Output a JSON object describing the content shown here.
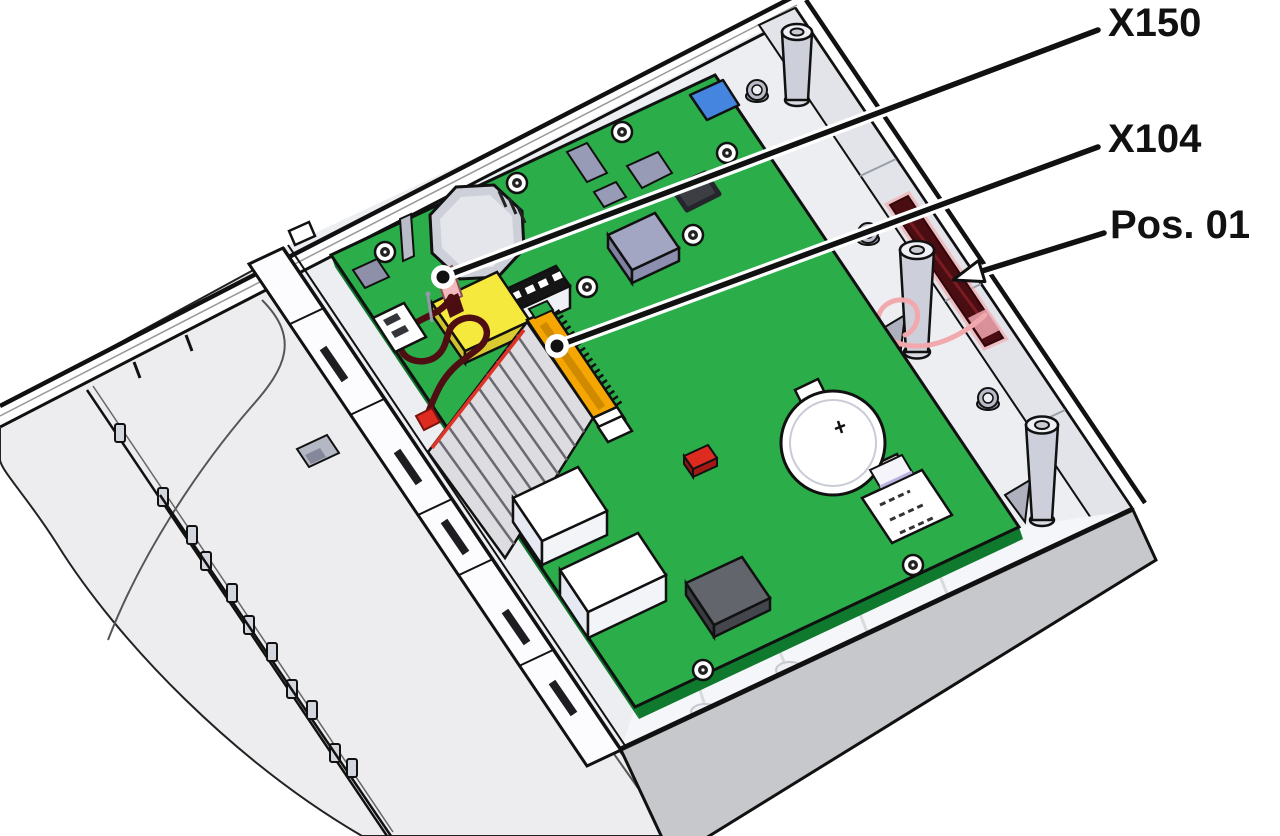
{
  "figure": {
    "type": "technical-illustration",
    "description": "Open device enclosure (lid removed) with green mainboard installed, viewed at an angle. Callout leader lines identify antenna connector X150, ribbon-cable connector X104 and the antenna mounting position Pos. 01 on the enclosure side wall."
  },
  "callouts": [
    {
      "id": "x150",
      "label": "X150",
      "target": "antenna-connector-on-board"
    },
    {
      "id": "x104",
      "label": "X104",
      "target": "ribbon-cable-connector-on-board"
    },
    {
      "id": "pos01",
      "label": "Pos. 01",
      "target": "antenna-position-on-side-wall"
    }
  ],
  "colors": {
    "line": "#1a1a1a",
    "pcb_green": "#2bad4a",
    "pcb_edge_green": "#0f7a2e",
    "connector_orange": "#f5a602",
    "component_yellow": "#f5e93d",
    "component_blue": "#4585e0",
    "component_red": "#dd2b20",
    "wire_dark_red": "#4f0f12",
    "antenna_maroon": "#4a0d12",
    "antenna_pink": "#f2a9ae",
    "enclosure_gray": "#ededf0",
    "wall_gray": "#c6c8cc"
  }
}
